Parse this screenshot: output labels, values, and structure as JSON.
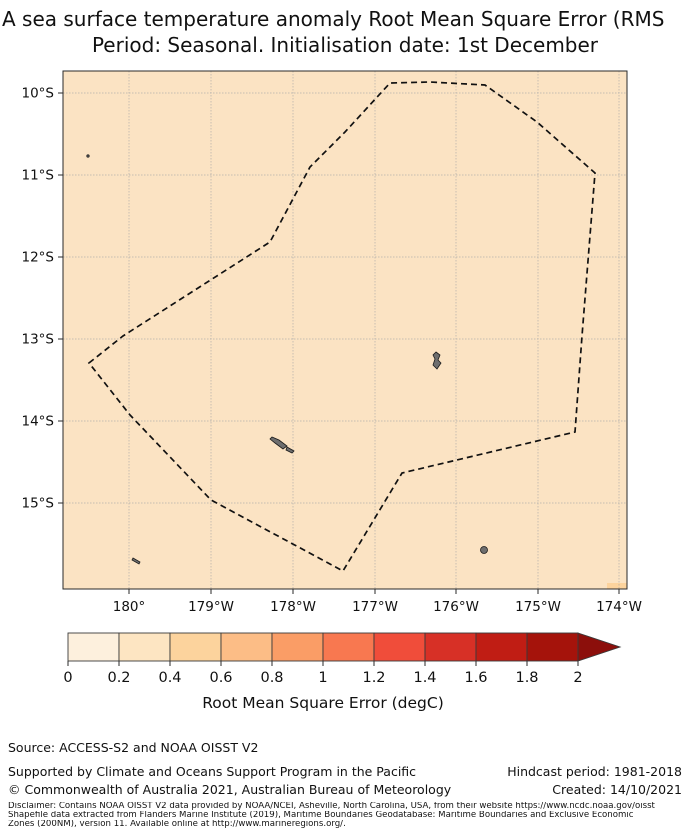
{
  "title": {
    "line1": "A sea surface temperature anomaly Root Mean Square Error (RMS",
    "line2": "Period: Seasonal. Initialisation date: 1st December"
  },
  "map": {
    "x_tick_labels": [
      "180°",
      "179°W",
      "178°W",
      "177°W",
      "176°W",
      "175°W",
      "174°W"
    ],
    "y_tick_labels": [
      "10°S",
      "11°S",
      "12°S",
      "13°S",
      "14°S",
      "15°S"
    ],
    "region_fill_color": "#fbe3c3",
    "hotspot_cell_color": "#fcd39d",
    "boundary_style": "dashed",
    "island_color": "#6e6e6e"
  },
  "colorbar": {
    "label": "Root Mean Square Error (degC)",
    "tick_labels": [
      "0",
      "0.2",
      "0.4",
      "0.6",
      "0.8",
      "1",
      "1.2",
      "1.4",
      "1.6",
      "1.8",
      "2"
    ],
    "colors": [
      "#fdf0dd",
      "#fde5c2",
      "#fcd39d",
      "#fcbd86",
      "#fa9d66",
      "#f87850",
      "#f04d3a",
      "#d73026",
      "#c01d14",
      "#a5130b",
      "#8c0f0b"
    ]
  },
  "chart_data": {
    "type": "heatmap",
    "title": "A sea surface temperature anomaly Root Mean Square Error (RMS",
    "subtitle": "Period: Seasonal. Initialisation date: 1st December",
    "x_axis": {
      "tick_labels": [
        "180°",
        "179°W",
        "178°W",
        "177°W",
        "176°W",
        "175°W",
        "174°W"
      ],
      "approx_range_deg_west": [
        180.8,
        173.9
      ]
    },
    "y_axis": {
      "tick_labels": [
        "10°S",
        "11°S",
        "12°S",
        "13°S",
        "14°S",
        "15°S"
      ],
      "approx_range_deg_south": [
        9.75,
        16.1
      ]
    },
    "colorbar": {
      "label": "Root Mean Square Error (degC)",
      "ticks": [
        0,
        0.2,
        0.4,
        0.6,
        0.8,
        1,
        1.2,
        1.4,
        1.6,
        1.8,
        2
      ],
      "bin_size": 0.2,
      "extend": "max",
      "grid": "on"
    },
    "field_summary": "RMSE nearly uniform in the 0.2-0.4 degC bin over the whole mapped region; a single 0.4-0.6 degC cell at the southern edge near 174.2°W; dashed EEZ boundary polygon enclosing Wallis and Futuna region; small islands drawn in grey"
  },
  "footer": {
    "source": "Source: ACCESS-S2 and NOAA OISST V2",
    "supported": "Supported by Climate and Oceans Support Program in the Pacific",
    "copyright": "© Commonwealth of Australia 2021, Australian Bureau of Meteorology",
    "hindcast": "Hindcast period: 1981-2018",
    "created": "Created: 14/10/2021",
    "disclaimer_line1": "Disclaimer: Contains NOAA OISST V2 data provided by NOAA/NCEI, Asheville, North Carolina, USA, from their website https://www.ncdc.noaa.gov/oisst",
    "disclaimer_line2": "Shapefile data extracted from Flanders Marine Institute (2019), Maritime Boundaries Geodatabase: Maritime Boundaries and Exclusive Economic",
    "disclaimer_line3": "Zones (200NM), version 11. Available online at http://www.marineregions.org/."
  }
}
